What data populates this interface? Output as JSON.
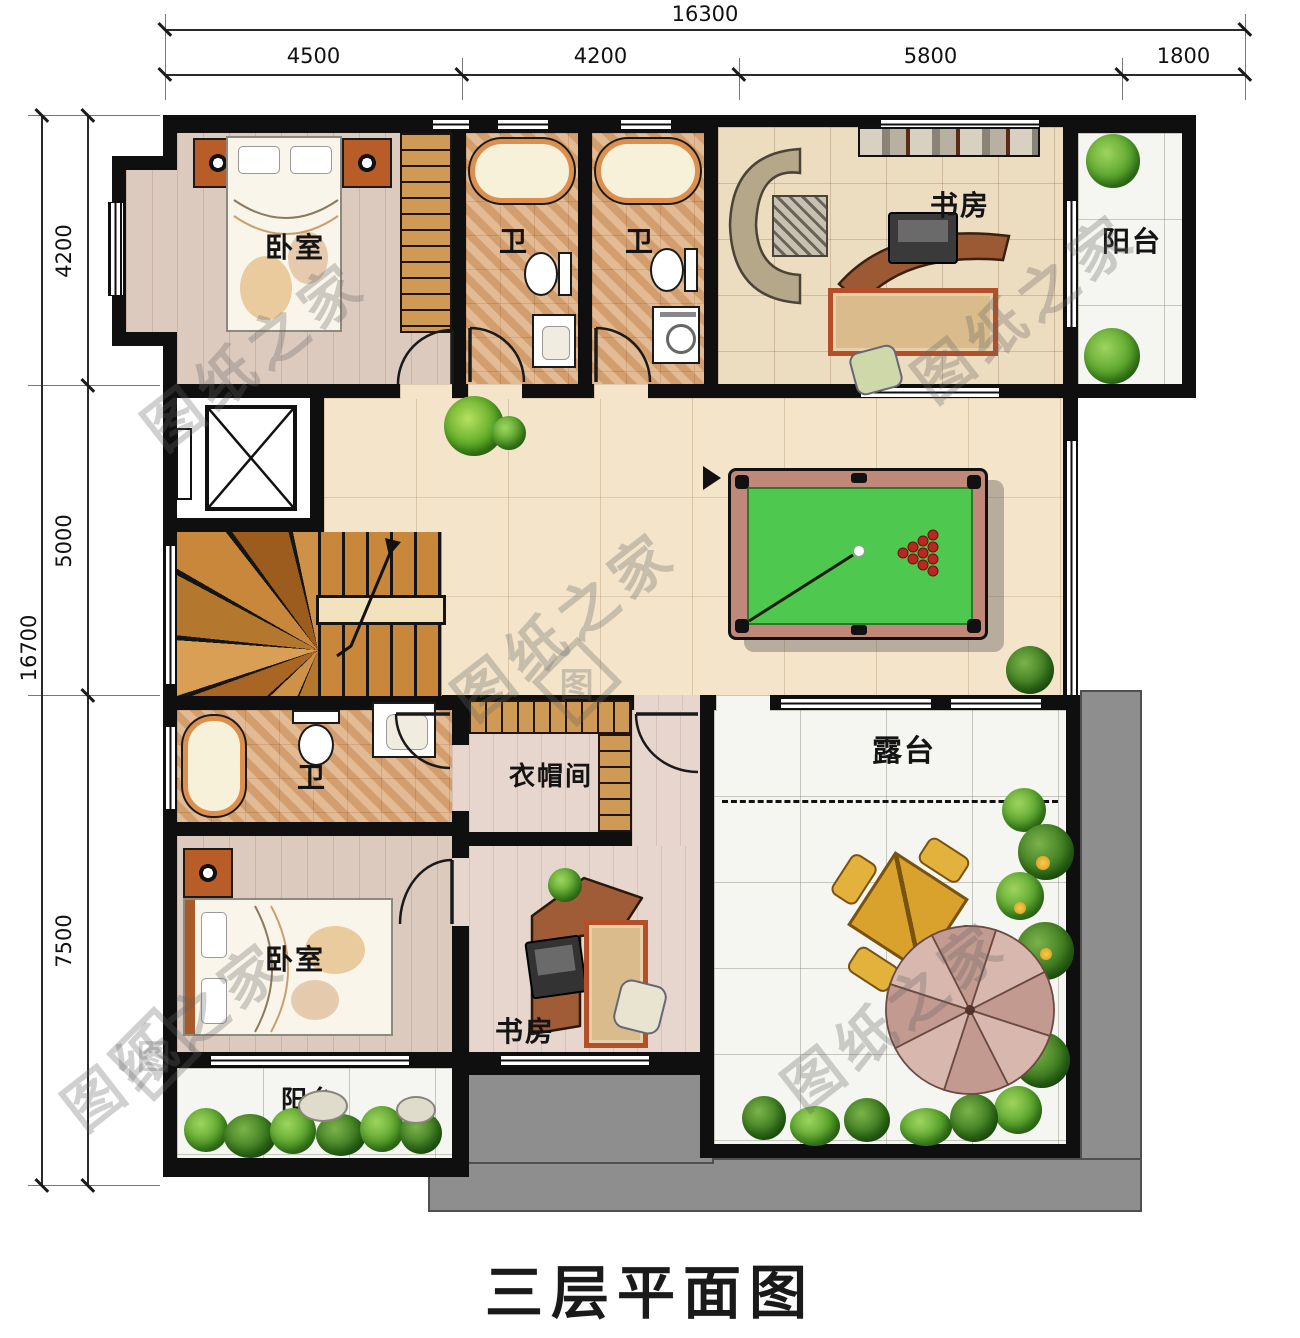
{
  "title": "三层平面图",
  "watermark": "图纸之家",
  "watermark_logo_char": "图",
  "dimensions": {
    "top_total": "16300",
    "top_segments": [
      "4500",
      "4200",
      "5800",
      "1800"
    ],
    "left_total": "16700",
    "left_segments": [
      "4200",
      "5000",
      "7500"
    ]
  },
  "rooms": {
    "bedroom_top": "卧室",
    "bath_top_left": "卫",
    "bath_top_right": "卫",
    "study_top": "书房",
    "balcony_top": "阳台",
    "bath_bottom": "卫",
    "cloakroom": "衣帽间",
    "bedroom_bottom": "卧室",
    "study_bottom": "书房",
    "balcony_bottom": "阳台",
    "terrace": "露台"
  },
  "colors": {
    "wall": "#0f0f0f",
    "roof_gray": "#8e8e8e",
    "billiard_felt": "#4fc84f",
    "billiard_rail": "#c08878",
    "hall_floor": "#f3e4ca",
    "bath_floor": "#dcab7c",
    "bedroom_floor": "#dccabf",
    "stair_wood": "#c8873b"
  }
}
